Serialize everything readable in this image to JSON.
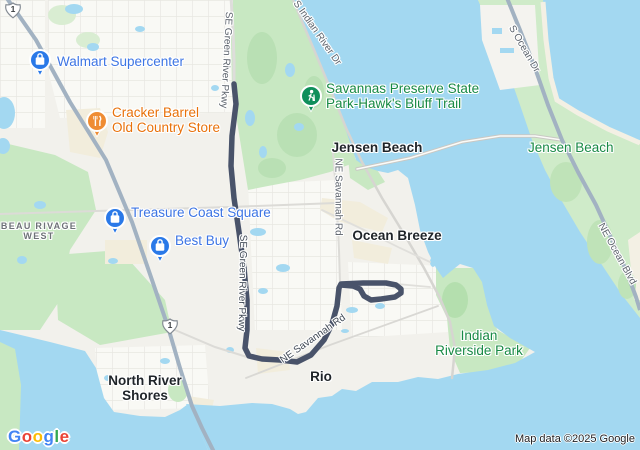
{
  "attribution": "Map data ©2025 Google",
  "logo": {
    "letters": [
      "G",
      "o",
      "o",
      "g",
      "l",
      "e"
    ],
    "colors": [
      "#4285F4",
      "#EA4335",
      "#FBBC05",
      "#4285F4",
      "#34A853",
      "#EA4335"
    ]
  },
  "route_shields": [
    "1",
    "1"
  ],
  "colors": {
    "water": "#a3d8f1",
    "land": "#f2f1ec",
    "park_green": "#c8e8c2",
    "island_green": "#cfebc9",
    "route": "#49536a",
    "highway": "#a2b2c2",
    "poi_shopping": "#3d75e4",
    "poi_restaurant_text": "#e8710a",
    "poi_restaurant_icon": "#ef8c33",
    "poi_park_text": "#188a45",
    "poi_park_icon": "#0f8f5b",
    "city_text": "#1f2429",
    "neighborhood_text": "#6d7277",
    "road_label": "#5d646d"
  },
  "places": {
    "walmart": "Walmart Supercenter",
    "cracker_barrel": [
      "Cracker Barrel",
      "Old Country Store"
    ],
    "treasure_coast": "Treasure Coast Square",
    "best_buy": "Best Buy",
    "savannas": [
      "Savannas Preserve State",
      "Park-Hawk's Bluff Trail"
    ],
    "indian_riverside": [
      "Indian",
      "Riverside Park"
    ],
    "jensen_beach_city": "Jensen Beach",
    "jensen_beach_area": "Jensen Beach",
    "ocean_breeze": "Ocean Breeze",
    "rio": "Rio",
    "north_river_shores": [
      "North River",
      "Shores"
    ],
    "beau_rivage": [
      "BEAU RIVAGE",
      "WEST"
    ]
  },
  "roads": {
    "green_river_pkwy_top": "SE Green River Pkwy",
    "green_river_pkwy_mid": "SE Green River Pkwy",
    "savannah_rd_vertical": "NE Savannah Rd",
    "savannah_rd_diagonal": "NE Savannah Rd",
    "indian_river_dr": "S Indian River Dr",
    "ocean_dr": "S Ocean Dr",
    "ocean_blvd": "NE Ocean Blvd"
  }
}
